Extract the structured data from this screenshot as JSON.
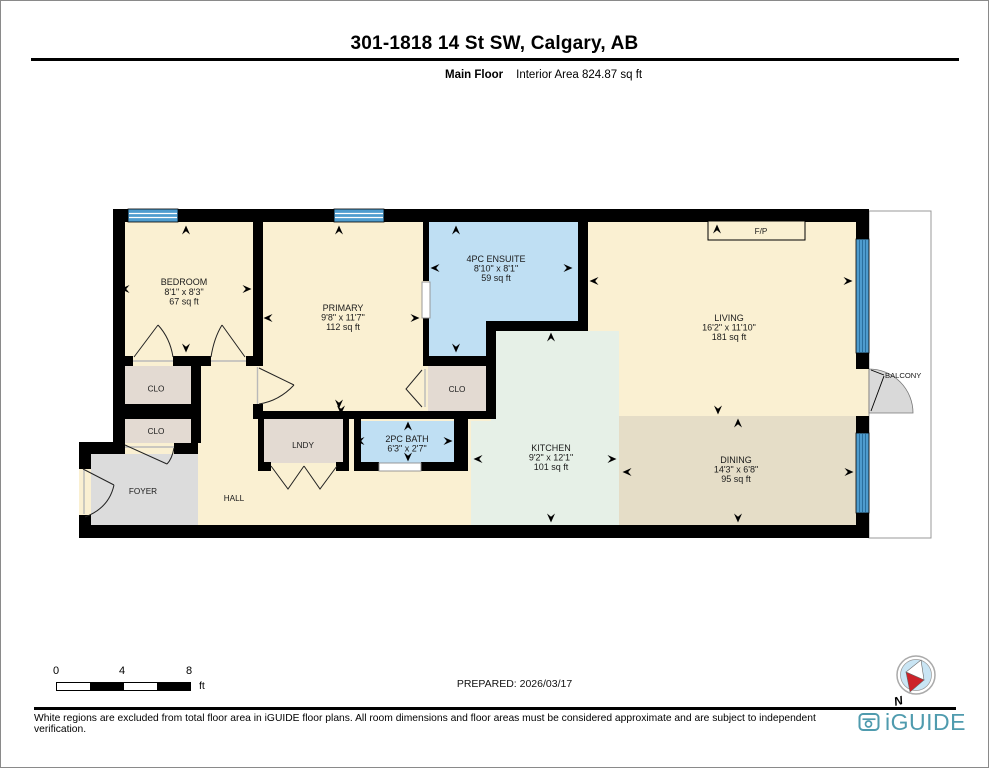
{
  "page": {
    "title": "301-1818 14 St SW, Calgary, AB",
    "floor_label": "Main Floor",
    "area_label": "Interior Area 824.87 sq ft",
    "prepared_label": "PREPARED: 2026/03/17",
    "disclaimer": "White regions are excluded from total floor area in iGUIDE floor plans. All room dimensions and floor areas must be considered approximate and are subject to independent verification.",
    "brand": "iGUIDE",
    "compass_north": "N"
  },
  "scale_bar": {
    "ticks": [
      "0",
      "4",
      "8"
    ],
    "unit": "ft"
  },
  "rooms": {
    "bedroom": {
      "name": "BEDROOM",
      "dims": "8'1\" x 8'3\"",
      "area": "67 sq ft"
    },
    "primary": {
      "name": "PRIMARY",
      "dims": "9'8\" x 11'7\"",
      "area": "112 sq ft"
    },
    "ensuite": {
      "name": "4PC ENSUITE",
      "dims": "8'10\" x 8'1\"",
      "area": "59 sq ft"
    },
    "living": {
      "name": "LIVING",
      "dims": "16'2\" x 11'10\"",
      "area": "181 sq ft"
    },
    "kitchen": {
      "name": "KITCHEN",
      "dims": "9'2\" x 12'1\"",
      "area": "101 sq ft"
    },
    "dining": {
      "name": "DINING",
      "dims": "14'3\" x 6'8\"",
      "area": "95 sq ft"
    },
    "bath": {
      "name": "2PC BATH",
      "dims": "6'3\" x 2'7\""
    },
    "clo1": {
      "name": "CLO"
    },
    "clo2": {
      "name": "CLO"
    },
    "clo3": {
      "name": "CLO"
    },
    "lndy": {
      "name": "LNDY"
    },
    "foyer": {
      "name": "FOYER"
    },
    "hall": {
      "name": "HALL"
    },
    "balcony": {
      "name": "BALCONY"
    },
    "fireplace": {
      "name": "F/P"
    }
  },
  "colors": {
    "wall": "#000000",
    "room_cream": "#FAF0D2",
    "room_blue": "#BFDFF3",
    "kitchen_green": "#E6F0E7",
    "dining_tan": "#E5DDC7",
    "foyer_gray": "#DCDCDC",
    "closet_beige": "#E3DAD2",
    "window_blue": "#4E9CCE",
    "brand_teal": "#4F9BAE",
    "compass_red": "#CC2229",
    "compass_blue": "#C9E5F4"
  }
}
